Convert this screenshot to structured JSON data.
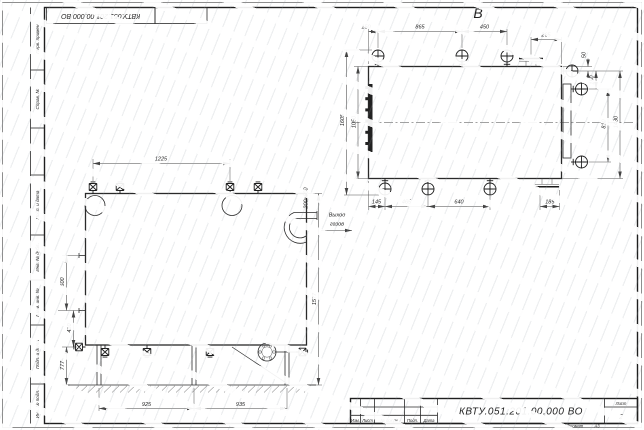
{
  "sheet": {
    "corner_designation": "КВТУ.051.201.00.000  ВО",
    "margin_fields": [
      "Перв. примен.",
      "Справ. №",
      "Подп. и дата",
      "Инв. № дубл.",
      "Взам. инв. №",
      "Подп. и дата",
      "Инв. № подл."
    ],
    "title_block": {
      "designation": "КВТУ.051.201.00.000  ВО",
      "columns": [
        "Изм.",
        "Лист",
        "№ докум.",
        "Подп.",
        "Дата"
      ],
      "sheet_label": "Лист",
      "sheet_number": "2",
      "format_label": "Формат",
      "format_value": "А3"
    }
  },
  "front_view": {
    "dim_top": "1225",
    "dims_left": [
      "500",
      "410",
      "777"
    ],
    "dim_right": "1577",
    "outlet_size": "200х600",
    "outlet_note_line1": "Выход",
    "outlet_note_line2": "газов",
    "dim_bottom_left": "925",
    "dim_bottom_right": "935"
  },
  "top_view": {
    "label": "В",
    "dims_top": [
      "150",
      "865",
      "450",
      "265"
    ],
    "dim_corner": "50",
    "dims_right": [
      "150",
      "810",
      "1430"
    ],
    "dims_left": [
      "1605",
      "1050"
    ],
    "dims_bottom": [
      "145",
      "465",
      "640",
      "185"
    ]
  }
}
